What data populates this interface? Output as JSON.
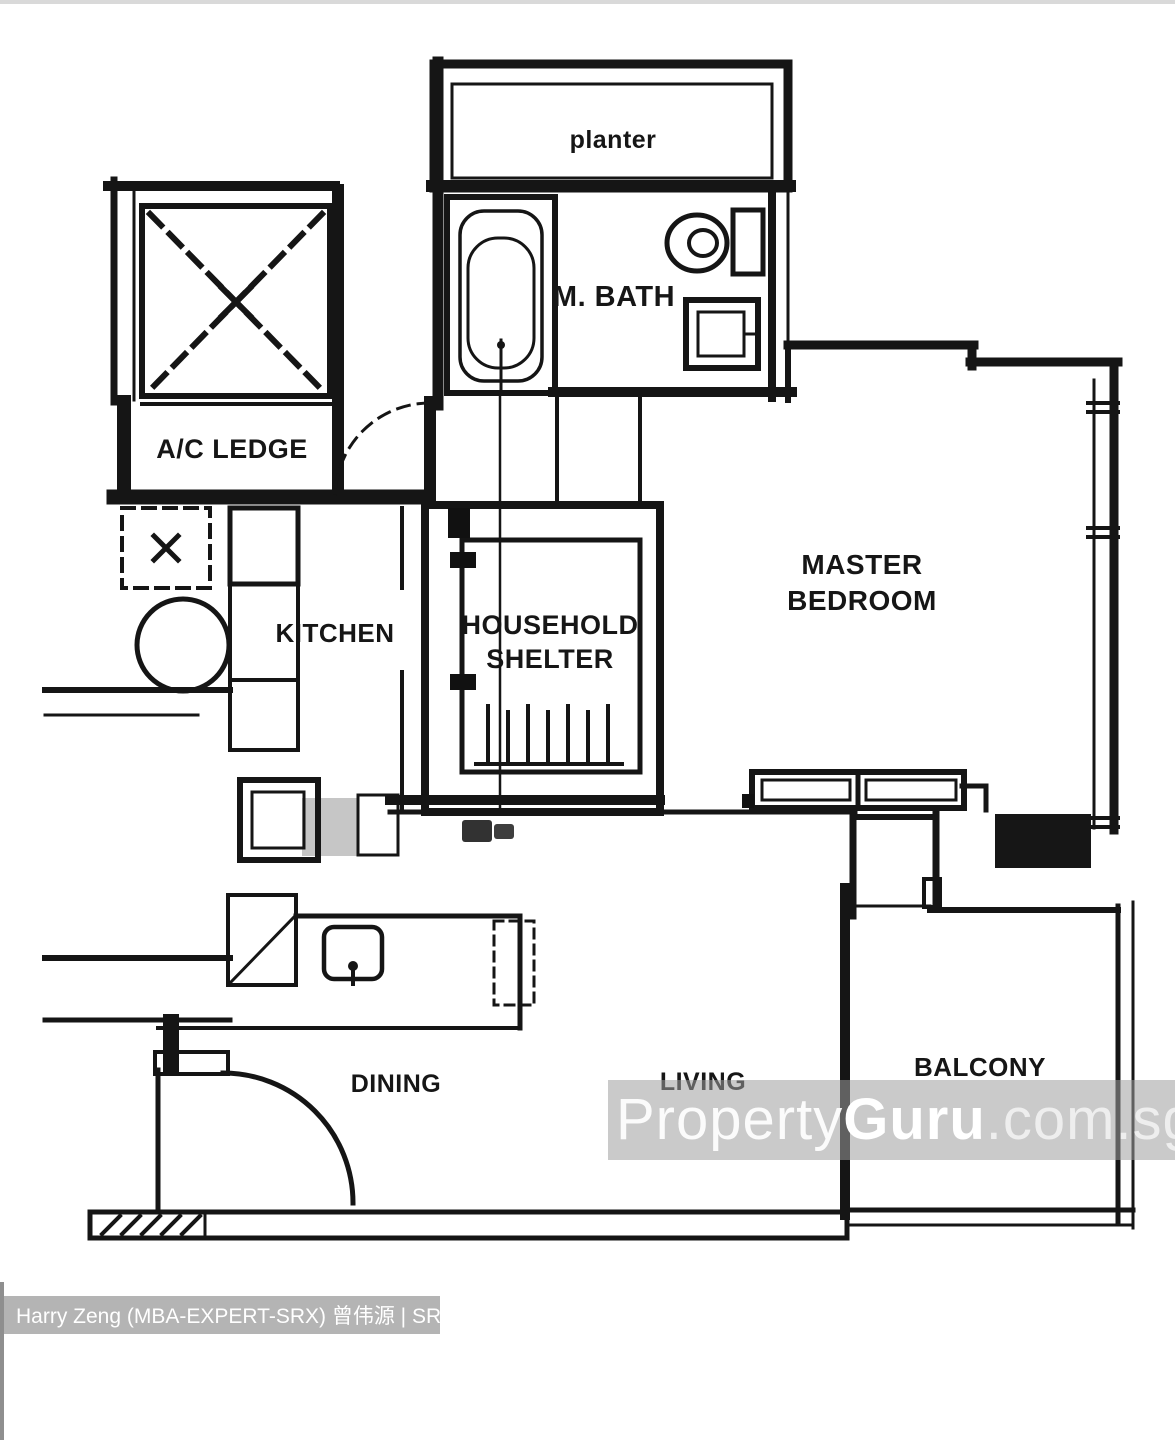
{
  "floor_plan": {
    "rooms": {
      "planter": "planter",
      "master_bath": "M. BATH",
      "ac_ledge": "A/C LEDGE",
      "kitchen": "KITCHEN",
      "household_shelter_line1": "HOUSEHOLD",
      "household_shelter_line2": "SHELTER",
      "master_bedroom_line1": "MASTER",
      "master_bedroom_line2": "BEDROOM",
      "dining": "DINING",
      "living": "LIVING",
      "balcony": "BALCONY"
    }
  },
  "watermark": {
    "part1": "Property",
    "part2": "Guru",
    "part3": ".com.sg",
    "band_color": "rgba(158,158,158,0.55)"
  },
  "agent_banner": {
    "text": "Harry Zeng (MBA-EXPERT-SRX) 曾伟源 | SRX PROPERTY",
    "background": "#b4b4b4",
    "text_color": "#ffffff"
  },
  "colors": {
    "ink": "#151515",
    "paper": "#ffffff",
    "top_hairline": "#d9d9d9"
  }
}
